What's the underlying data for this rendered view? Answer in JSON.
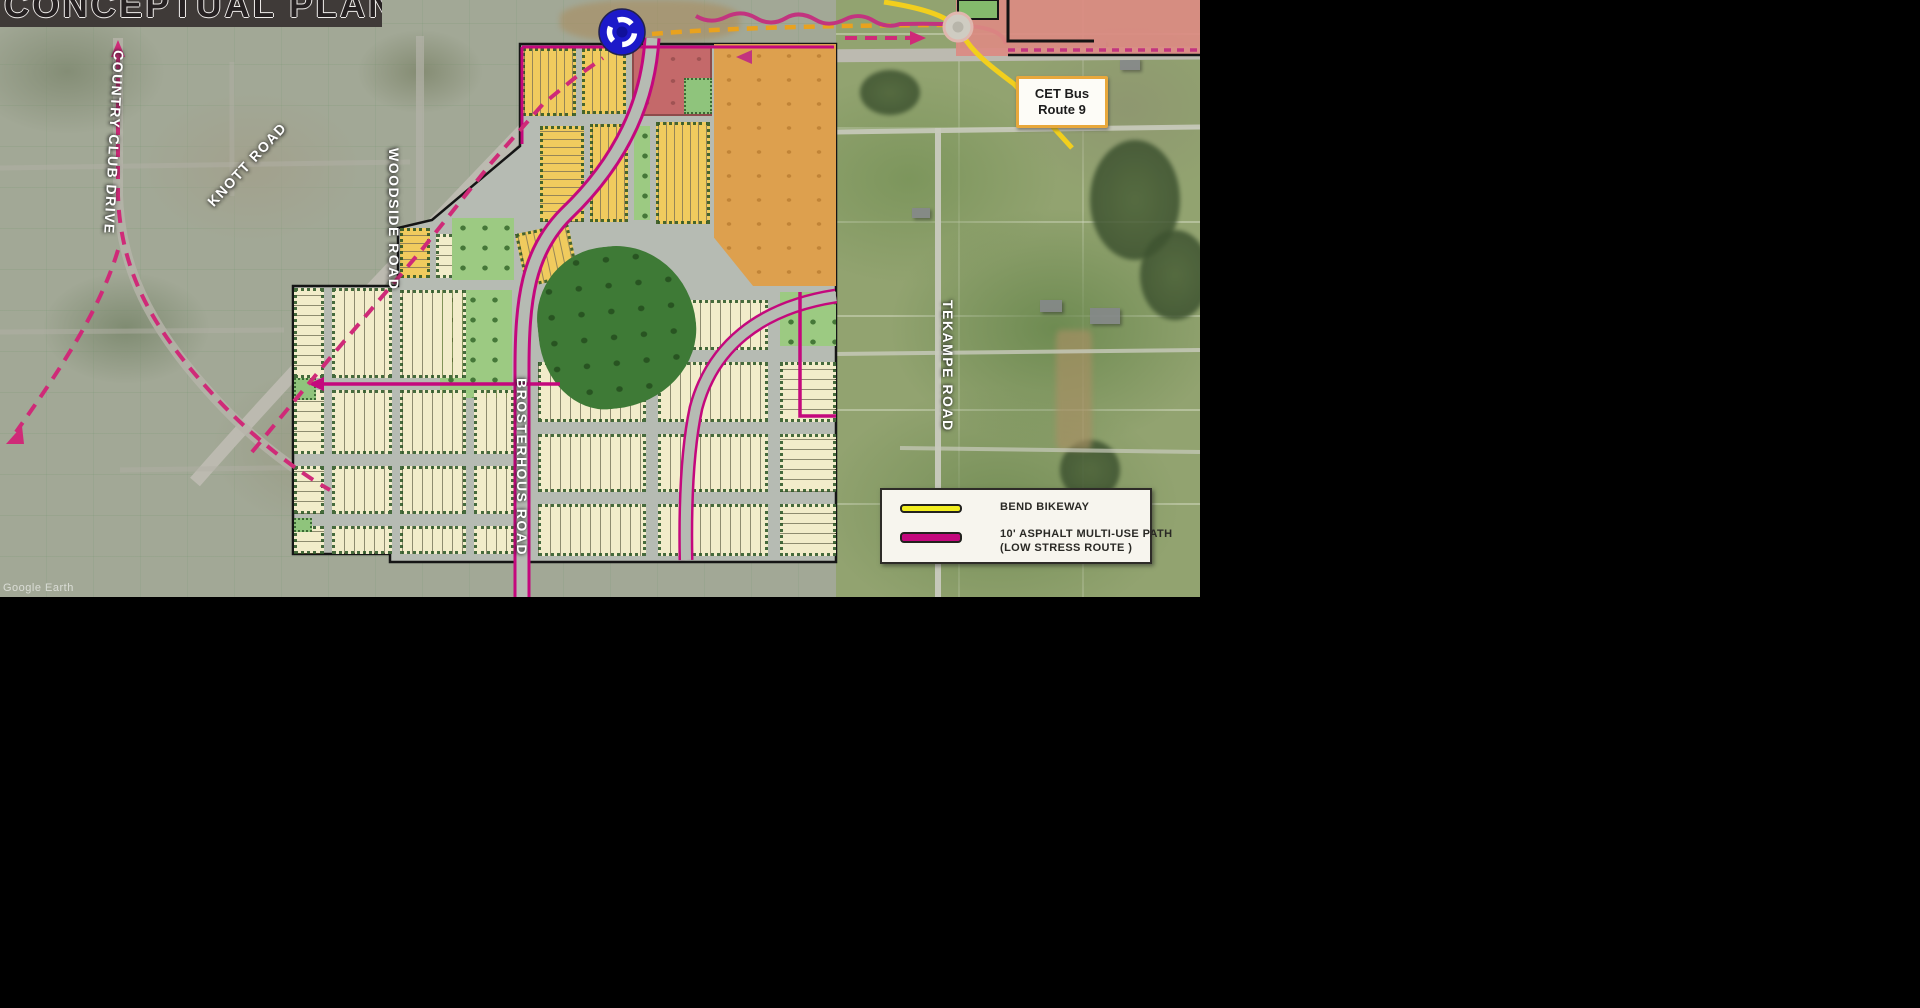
{
  "title": "CONCEPTUAL PLAN",
  "map": {
    "road_labels": {
      "country_club": "COUNTRY CLUB DRIVE",
      "knott": "KNOTT ROAD",
      "woodside": "WOODSIDE ROAD",
      "brosterhous": "BROSTERHOUS ROAD",
      "tekampe": "TEKAMPE ROAD"
    },
    "bus_callout": {
      "line1": "CET Bus",
      "line2": "Route 9"
    },
    "watermark": "Google Earth"
  },
  "legend": {
    "items": [
      {
        "label": "BEND BIKEWAY",
        "swatch_color": "#f2ee1f"
      },
      {
        "label": "10' ASPHALT MULTI-USE PATH",
        "label_line2": "(LOW STRESS ROUTE )",
        "swatch_color": "#c4087d"
      }
    ]
  },
  "colors": {
    "multi_use_path": "#c4087d",
    "bikeway": "#f2cf1d",
    "bus_route": "#e9a21e",
    "roundabout_icon": "#1c19c9",
    "park_green": "#3e7a36",
    "lot_cream": "#f2ecca",
    "lot_gold": "#f0cb5e",
    "school_orange": "#dda04e",
    "commercial_red": "#c4696a"
  }
}
